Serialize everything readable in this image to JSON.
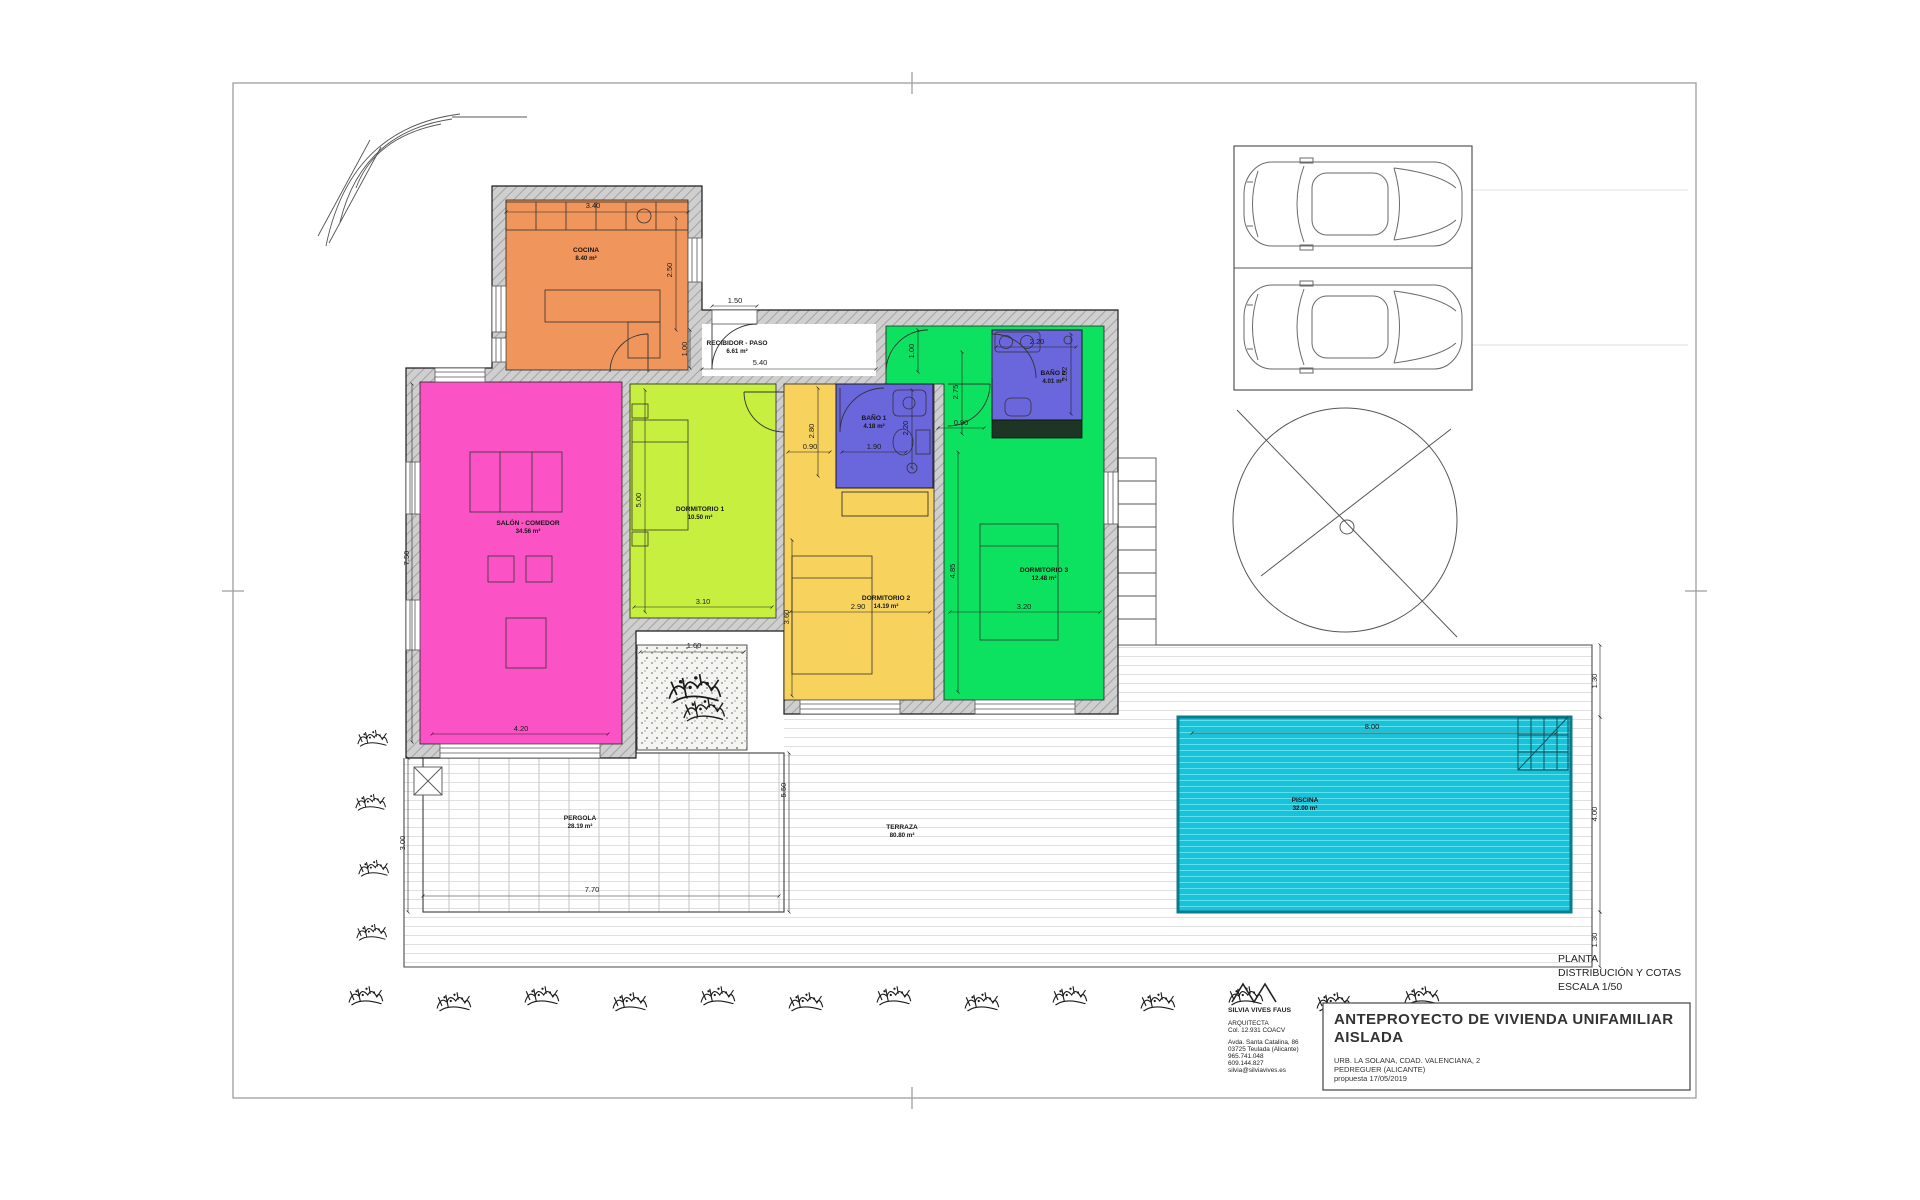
{
  "palette": {
    "kitchen": "#F0955C",
    "living": "#FB53C5",
    "bedroom1": "#C7EF3F",
    "bedroom2": "#F7D35E",
    "bedroom3": "#0CE25F",
    "bathroom": "#6A66DB",
    "pool": "#17C3D8",
    "pool_border": "#0C7B8C",
    "wall_gray": "#CFCFCF",
    "line_dark": "#1c1c1c"
  },
  "view_title": {
    "line1": "PLANTA",
    "line2": "DISTRIBUCIÓN Y COTAS",
    "line3": "ESCALA 1/50"
  },
  "title_block": {
    "project_line1": "ANTEPROYECTO DE VIVIENDA UNIFAMILIAR",
    "project_line2": "AISLADA",
    "address_line1": "URB. LA SOLANA, CDAD. VALENCIANA, 2",
    "address_line2": "PEDREGUER (ALICANTE)",
    "address_line3": "propuesta 17/05/2019"
  },
  "architect": {
    "name": "SILVIA VIVES FAUS",
    "title": "ARQUITECTA",
    "license": "Col. 12.931 COACV",
    "address1": "Avda. Santa Catalina, 86",
    "address2": "03725 Teulada (Alicante)",
    "phone1": "965.741.048",
    "phone2": "609.144.827",
    "email": "silvia@silviavives.es"
  },
  "rooms": [
    {
      "name": "COCINA",
      "area": "8.40 m²",
      "x": 586,
      "y": 252
    },
    {
      "name": "RECIBIDOR - PASO",
      "area": "6.61 m²",
      "x": 737,
      "y": 345
    },
    {
      "name": "SALÓN - COMEDOR",
      "area": "34.56 m²",
      "x": 528,
      "y": 525
    },
    {
      "name": "DORMITORIO 1",
      "area": "10.50 m²",
      "x": 700,
      "y": 511
    },
    {
      "name": "DORMITORIO 2",
      "area": "14.19 m²",
      "x": 886,
      "y": 600
    },
    {
      "name": "DORMITORIO 3",
      "area": "12.48 m²",
      "x": 1044,
      "y": 572
    },
    {
      "name": "BAÑO 1",
      "area": "4.18 m²",
      "x": 874,
      "y": 420
    },
    {
      "name": "BAÑO 2",
      "area": "4.01 m²",
      "x": 1053,
      "y": 375
    },
    {
      "name": "PISCINA",
      "area": "32.00 m²",
      "x": 1305,
      "y": 802
    },
    {
      "name": "TERRAZA",
      "area": "80.80 m²",
      "x": 902,
      "y": 829
    },
    {
      "name": "PERGOLA",
      "area": "28.19 m²",
      "x": 580,
      "y": 820
    }
  ],
  "dimensions": [
    {
      "label": "3.40",
      "x": 593,
      "y": 208,
      "rot": false
    },
    {
      "label": "2.50",
      "x": 672,
      "y": 270,
      "rot": true
    },
    {
      "label": "1.50",
      "x": 735,
      "y": 303,
      "rot": false
    },
    {
      "label": "1.00",
      "x": 687,
      "y": 349,
      "rot": true
    },
    {
      "label": "5.40",
      "x": 760,
      "y": 365,
      "rot": false
    },
    {
      "label": "7.50",
      "x": 409,
      "y": 558,
      "rot": true
    },
    {
      "label": "4.20",
      "x": 521,
      "y": 731,
      "rot": false
    },
    {
      "label": "5.00",
      "x": 641,
      "y": 500,
      "rot": true
    },
    {
      "label": "3.10",
      "x": 703,
      "y": 604,
      "rot": false
    },
    {
      "label": "2.80",
      "x": 814,
      "y": 431,
      "rot": true
    },
    {
      "label": "0.90",
      "x": 810,
      "y": 449,
      "rot": false
    },
    {
      "label": "1.90",
      "x": 874,
      "y": 449,
      "rot": false
    },
    {
      "label": "2.20",
      "x": 908,
      "y": 428,
      "rot": true
    },
    {
      "label": "2.20",
      "x": 1037,
      "y": 344,
      "rot": false
    },
    {
      "label": "2.02",
      "x": 1067,
      "y": 374,
      "rot": true
    },
    {
      "label": "1.00",
      "x": 914,
      "y": 351,
      "rot": true
    },
    {
      "label": "2.75",
      "x": 958,
      "y": 392,
      "rot": true
    },
    {
      "label": "0.90",
      "x": 961,
      "y": 425,
      "rot": false
    },
    {
      "label": "3.60",
      "x": 789,
      "y": 617,
      "rot": true
    },
    {
      "label": "2.90",
      "x": 858,
      "y": 609,
      "rot": false
    },
    {
      "label": "3.20",
      "x": 1024,
      "y": 609,
      "rot": false
    },
    {
      "label": "4.85",
      "x": 955,
      "y": 571,
      "rot": true
    },
    {
      "label": "8.00",
      "x": 1372,
      "y": 729,
      "rot": false
    },
    {
      "label": "1.30",
      "x": 1597,
      "y": 681,
      "rot": true
    },
    {
      "label": "4.00",
      "x": 1597,
      "y": 814,
      "rot": true
    },
    {
      "label": "1.30",
      "x": 1597,
      "y": 940,
      "rot": true
    },
    {
      "label": "1.60",
      "x": 694,
      "y": 648,
      "rot": false
    },
    {
      "label": "5.50",
      "x": 786,
      "y": 790,
      "rot": true
    },
    {
      "label": "3.00",
      "x": 405,
      "y": 843,
      "rot": true
    },
    {
      "label": "7.70",
      "x": 592,
      "y": 892,
      "rot": false
    }
  ]
}
